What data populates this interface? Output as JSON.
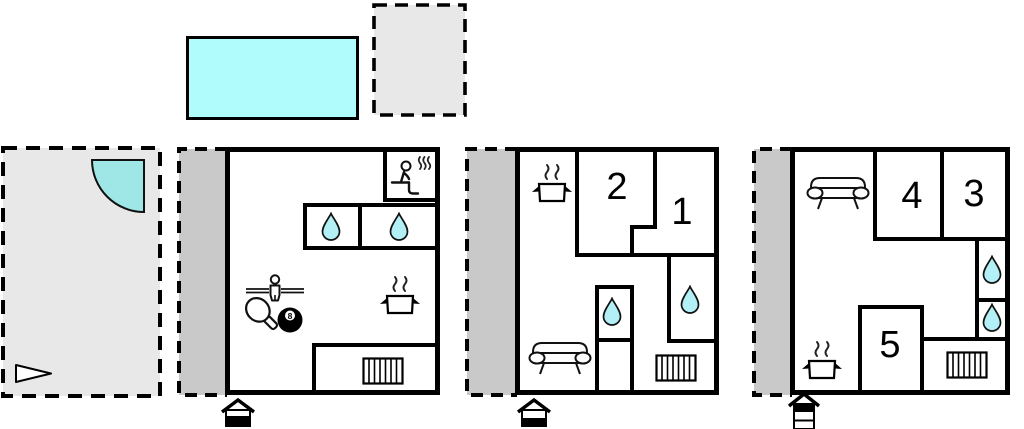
{
  "document": {
    "type": "holiday-home floor plan",
    "units_count": 3
  },
  "labels": {
    "room1": "1",
    "room2": "2",
    "room3": "3",
    "room4": "4",
    "room5": "5",
    "billiard_ball": "8"
  },
  "colors": {
    "pool_fill": "#b0fbfb",
    "spa_fill": "#9fe6e6",
    "water_drop_fill": "#b2f0f6",
    "terrace_light": "#e8e8e8",
    "terrace_covered": "#c9c9c9",
    "wall": "#000000",
    "background": "#ffffff"
  },
  "outdoor": {
    "pool_icon": "swimming-pool",
    "top_terrace_icon": "open-terrace",
    "left_terrace_icons": [
      "corner-spa",
      "flag-triangle"
    ]
  },
  "plans": [
    {
      "unit": "unit-1",
      "floor_indicator": "house-2-levels-lower-filled",
      "features": [
        "sauna",
        "shower",
        "shower",
        "foosball",
        "table-tennis",
        "billiards",
        "kitchen",
        "radiator",
        "covered-terrace"
      ]
    },
    {
      "unit": "unit-2",
      "floor_indicator": "house-2-levels-lower-filled",
      "bedrooms": [
        "1",
        "2"
      ],
      "features": [
        "kitchen",
        "shower",
        "shower",
        "sofa",
        "radiator",
        "covered-terrace"
      ]
    },
    {
      "unit": "unit-3",
      "floor_indicator": "house-3-levels-top-filled",
      "bedrooms": [
        "3",
        "4",
        "5"
      ],
      "features": [
        "sofa",
        "shower",
        "shower",
        "kitchen",
        "radiator",
        "covered-terrace"
      ]
    }
  ]
}
